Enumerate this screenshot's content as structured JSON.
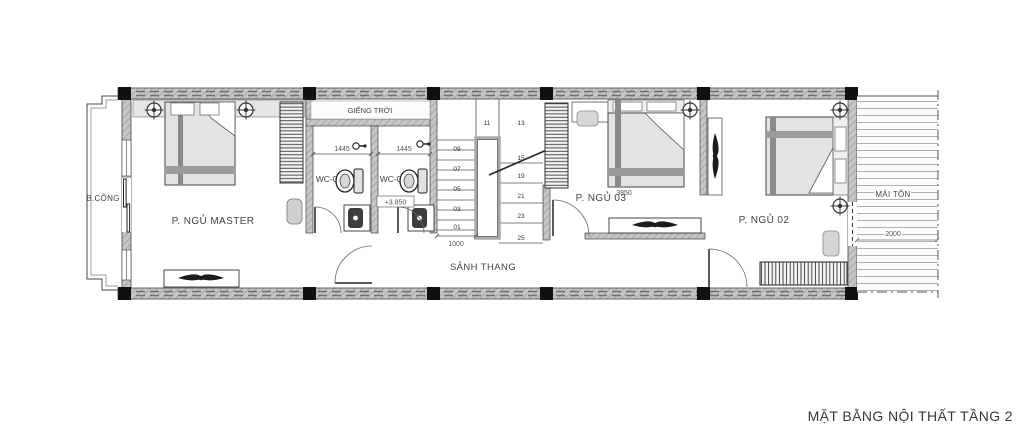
{
  "title": "MẶT BẰNG NỘI THẤT TẦNG 2",
  "labels": {
    "balcony": "B.CÔNG",
    "master_bedroom": "P. NGỦ MASTER",
    "skylight": "GIẾNG TRỜI",
    "wc02": "WC-02",
    "wc03": "WC-03",
    "stair_hall": "SẢNH THANG",
    "bedroom3": "P. NGỦ 03",
    "bedroom2": "P. NGỦ 02",
    "roof": "MÁI TÔN"
  },
  "dimensions": {
    "wc02_width": "1445",
    "wc03_width": "1445",
    "stair_width": "1000",
    "bedroom3_width": "3850",
    "roof_width": "2000",
    "floor_elevation": "+3.850"
  },
  "stairs": {
    "steps_left": [
      "09",
      "07",
      "05",
      "03",
      "01"
    ],
    "steps_top": [
      "11",
      "13"
    ],
    "steps_right": [
      "15",
      "19",
      "21",
      "23",
      "25"
    ]
  },
  "colors": {
    "wall_fill": "#c6c6c6",
    "wall_hatch": "#969696",
    "line": "#2e2e2e",
    "furniture_fill": "#e3e3e3",
    "text": "#3a3a3a"
  }
}
